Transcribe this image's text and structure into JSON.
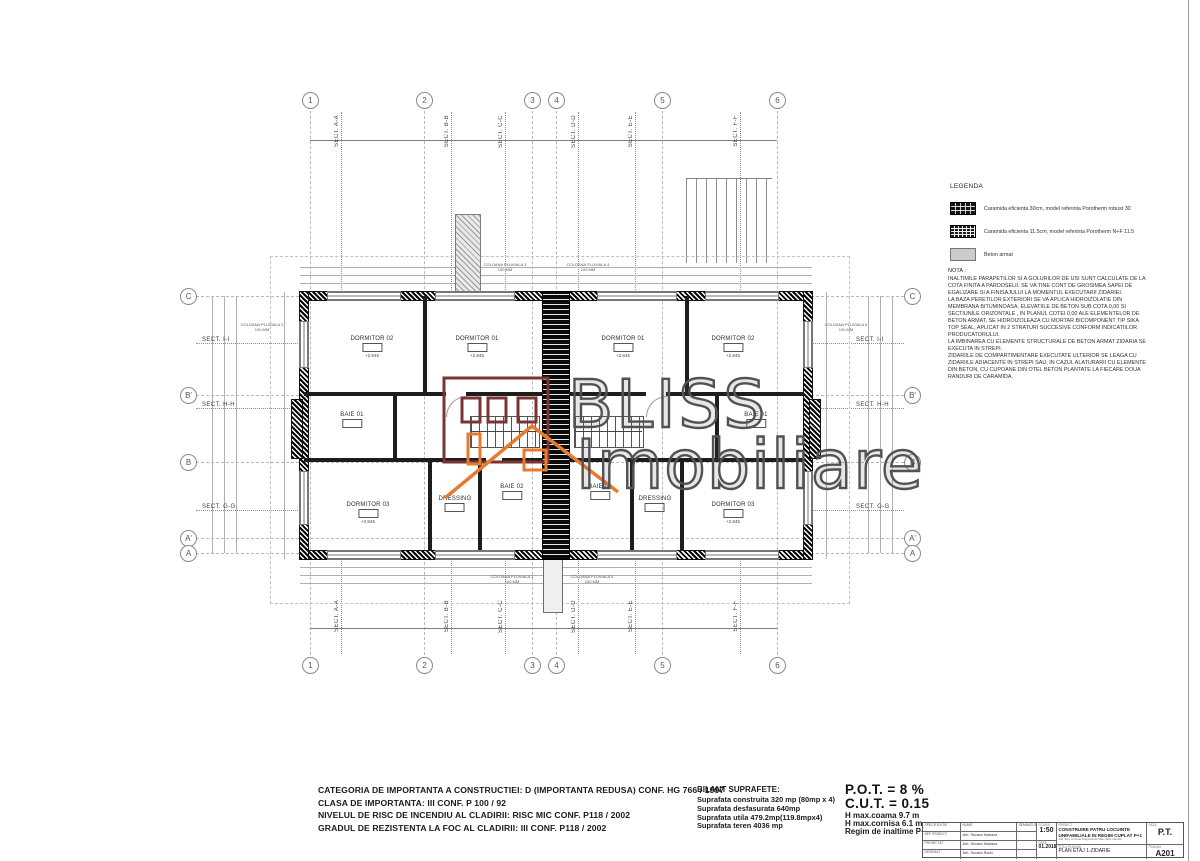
{
  "watermark": {
    "line1": "BLISS",
    "line2": "Imobiliare"
  },
  "legend": {
    "title": "LEGENDA",
    "items": [
      {
        "swatch": "brick-30-icon",
        "label": "Caramida eficienta 30cm, model referinta Porotherm robust 30"
      },
      {
        "swatch": "brick-115-icon",
        "label": "Caramida eficienta 11.5cm, model referinta Porotherm N+F 11.5"
      },
      {
        "swatch": "concrete-icon",
        "label": "Beton armat"
      }
    ]
  },
  "nota": {
    "title": "NOTA :",
    "text": "INALTIMILE PARAPETILOR SI A GOLURILOR DE USI SUNT CALCULATE DE LA COTA FINITA A PARDOSELII. SE VA TINE CONT DE GROSIMEA SAPEI DE EGALIZARE SI A FINISAJULUI LA MOMENTUL EXECUTARII ZIDARIEI.\nLA BAZA PERETILOR EXTERIORI SE VA APLICA HIDROIZOLATIE DIN MEMBRANA BITUMINOASA. ELEVATIILE DE BETON SUB COTA 0,00 SI SECTIUNILE ORIZONTALE , IN PLANUL COTEI 0,00 ALE ELEMENTELOR DE BETON ARMAT, SE HIDROIZOLEAZA CU MORTAR BICOMPONENT TIP SIKA TOP SEAL, APLICAT IN 2 STRATURI  SUCCESIVE CONFORM INDICATIILOR PRODUCATORULUI.\nLA IMBINAREA CU ELEMENTE STRUCTURALE DE BETON ARMAT ZIDARIA SE EXECUTA IN STREPI.\nZIDARIILE  DE COMPARTIMENTARE EXECUTATE ULTERIOR SE LEAGA CU ZIDARIILE ADIACENTE IN STREPI SAU, IN CAZUL ALATURARII CU ELEMENTE DIN BETON, CU CUPOANE DIN OTEL BETON PLANTATE LA FIECARE DOUA RANDURI DE CARAMIDA."
  },
  "plan": {
    "grid_cols": [
      "1",
      "2",
      "3",
      "4",
      "5",
      "6"
    ],
    "grid_rows": [
      "C",
      "B'",
      "B",
      "A'",
      "A"
    ],
    "sections_top": [
      "SECT. A-A",
      "SECT. B-B",
      "SECT. C-C",
      "SECT. D-D",
      "SECT. E-E",
      "SECT. F-F"
    ],
    "sections_side": [
      "SECT. I-I",
      "SECT. H-H",
      "SECT. G-G"
    ],
    "rooms": [
      {
        "name": "DORMITOR 02",
        "level": "+2.845"
      },
      {
        "name": "DORMITOR 01",
        "level": "+2.845"
      },
      {
        "name": "BAIE 01",
        "level": "+2.845"
      },
      {
        "name": "DORMITOR 03",
        "level": "+2.845"
      },
      {
        "name": "DRESSING",
        "level": "+2.845"
      },
      {
        "name": "BAIE 02",
        "level": "+2.845"
      },
      {
        "name": "DORMITOR 01",
        "level": "+2.845"
      },
      {
        "name": "DORMITOR 02",
        "level": "+2.845"
      },
      {
        "name": "BAIE 01",
        "level": "+2.845"
      },
      {
        "name": "DORMITOR 03",
        "level": "+2.845"
      },
      {
        "name": "DRESSING",
        "level": "+2.845"
      },
      {
        "name": "BAIE 02",
        "level": "+2.845"
      }
    ],
    "coloana": [
      {
        "text": "COLOANA PLUVIALA 3\n100 MM"
      },
      {
        "text": "COLOANA PLUVIALA 4\n100 MM"
      },
      {
        "text": "COLOANA PLUVIALA 2\n100 MM"
      },
      {
        "text": "COLOANA PLUVIALA 6\n100 MM"
      },
      {
        "text": "COLOANA PLUVIALA 1\n100 MM"
      },
      {
        "text": "COLOANA PLUVIALA 5\n100 MM"
      }
    ]
  },
  "footer": {
    "reglementari": "CATEGORIA DE IMPORTANTA  A  CONSTRUCTIEI: D (IMPORTANTA REDUSA) CONF. HG 766 / 1997\nCLASA DE IMPORTANTA: III CONF. P 100 / 92\nNIVELUL DE RISC DE INCENDIU AL CLADIRII: RISC MIC CONF. P118 / 2002\nGRADUL DE REZISTENTA LA FOC AL CLADIRII: III CONF. P118 / 2002",
    "bilant_title": "BILANT SUPRAFETE:",
    "bilant_lines": "Suprafata construita 320 mp (80mp x 4)\nSuprafata desfasurata 640mp\nSuprafata utila 479.2mp(119.8mpx4)\nSuprafata teren 4036 mp",
    "pot": "P.O.T.  = 8 %",
    "cut": "C.U.T.  = 0.15",
    "h_coama": "H max.coama 9.7 m",
    "h_cornisa": "H max.cornisa 6.1 m",
    "regim": "Regim de inaltime P+1"
  },
  "titleblock": {
    "col_specificatie": "SPECIFICATIE",
    "col_nume": "NUME",
    "col_semnatura": "SEMNATURA",
    "rows": [
      {
        "role": "SEF PROIECT",
        "name": "Arh. Secara Mariana"
      },
      {
        "role": "PROIECTAT",
        "name": "Arh. Secara Mariana"
      },
      {
        "role": "DESENAT",
        "name": "Arh. Secara Radu"
      }
    ],
    "scara_label": "SCARA",
    "scara": "1:50",
    "data_label": "DATA",
    "data": "01.2018",
    "proiect_label": "PROIECT",
    "proiect": "CONSTRUIRE PATRU LOCUINTE UNIFAMILIALE IN REGIM CUPLAT P+1",
    "adresa": "Jud. Ilfov, comuna Dragomiresti Vale, tarla, parcela",
    "faza_label": "FAZA",
    "faza": "P.T.",
    "titlu_label": "TITLU PLANSA",
    "titlu": "PLAN ETAJ 1-ZIDARIE",
    "plansa_label": "PLANSA",
    "plansa": "A201"
  }
}
